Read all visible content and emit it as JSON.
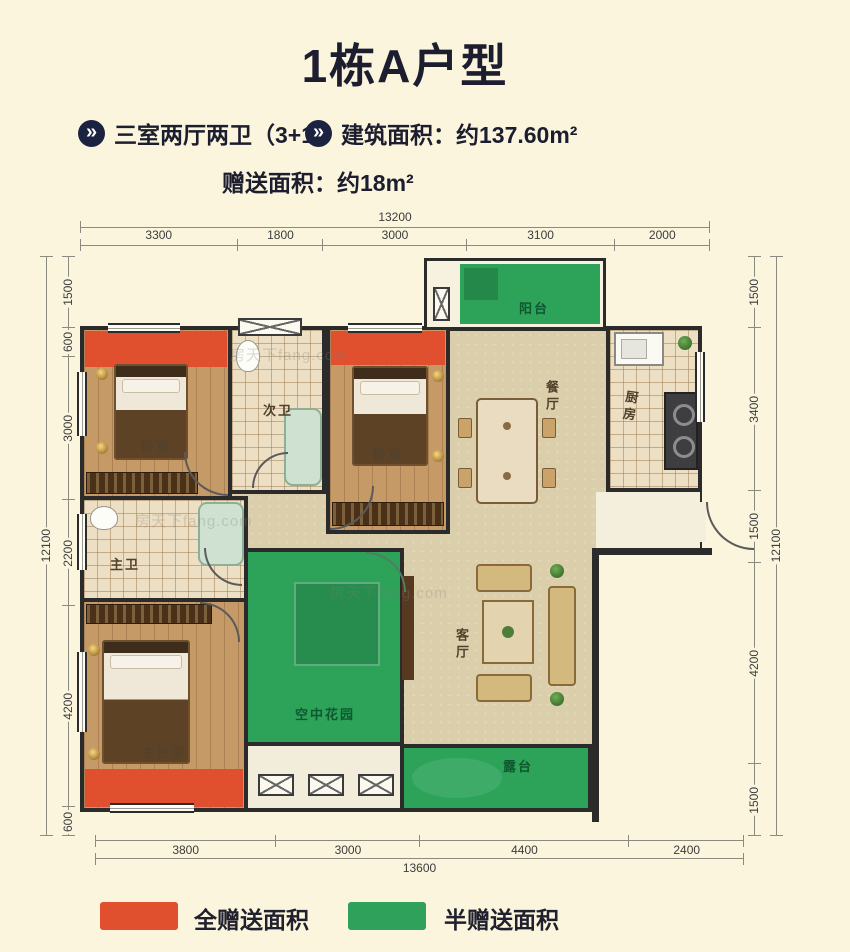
{
  "header": {
    "title": "1栋A户型",
    "bullet": "»",
    "feature1": "三室两厅两卫（3+1）",
    "feature2": "建筑面积：约137.60m²",
    "bonus": "赠送面积：约18m²"
  },
  "floorplan": {
    "labels": {
      "balcony": "阳台",
      "bedroom1": "卧室",
      "second_bath": "次卫",
      "bedroom2": "卧室",
      "dining": "餐厅",
      "kitchen": "厨房",
      "master_bath": "主卫",
      "master_bedroom": "主卧室",
      "sky_garden": "空中花园",
      "living_room": "客厅",
      "terrace": "露台"
    },
    "dimensions": {
      "top": {
        "total": "13200",
        "segments": [
          "3300",
          "1800",
          "3000",
          "3100",
          "2000"
        ]
      },
      "bottom": {
        "total": "13600",
        "segments": [
          "3800",
          "3000",
          "4400",
          "2400"
        ]
      },
      "left": {
        "total": "12100",
        "segments": [
          "1500",
          "600",
          "3000",
          "2200",
          "4200",
          "600"
        ]
      },
      "right": {
        "total": "12100",
        "segments": [
          "1500",
          "3400",
          "1500",
          "4200",
          "1500"
        ]
      }
    },
    "watermark": "房天下fang.com"
  },
  "legend": {
    "full_gift": {
      "label": "全赠送面积",
      "color": "#e0502f"
    },
    "half_gift": {
      "label": "半赠送面积",
      "color": "#2fa15a"
    }
  },
  "colors": {
    "background": "#faf5dc",
    "heading_text": "#1d1d30",
    "wall": "#2b2b2b",
    "full_gift_red": "#e0502f",
    "half_gift_green": "#2fa15a"
  }
}
